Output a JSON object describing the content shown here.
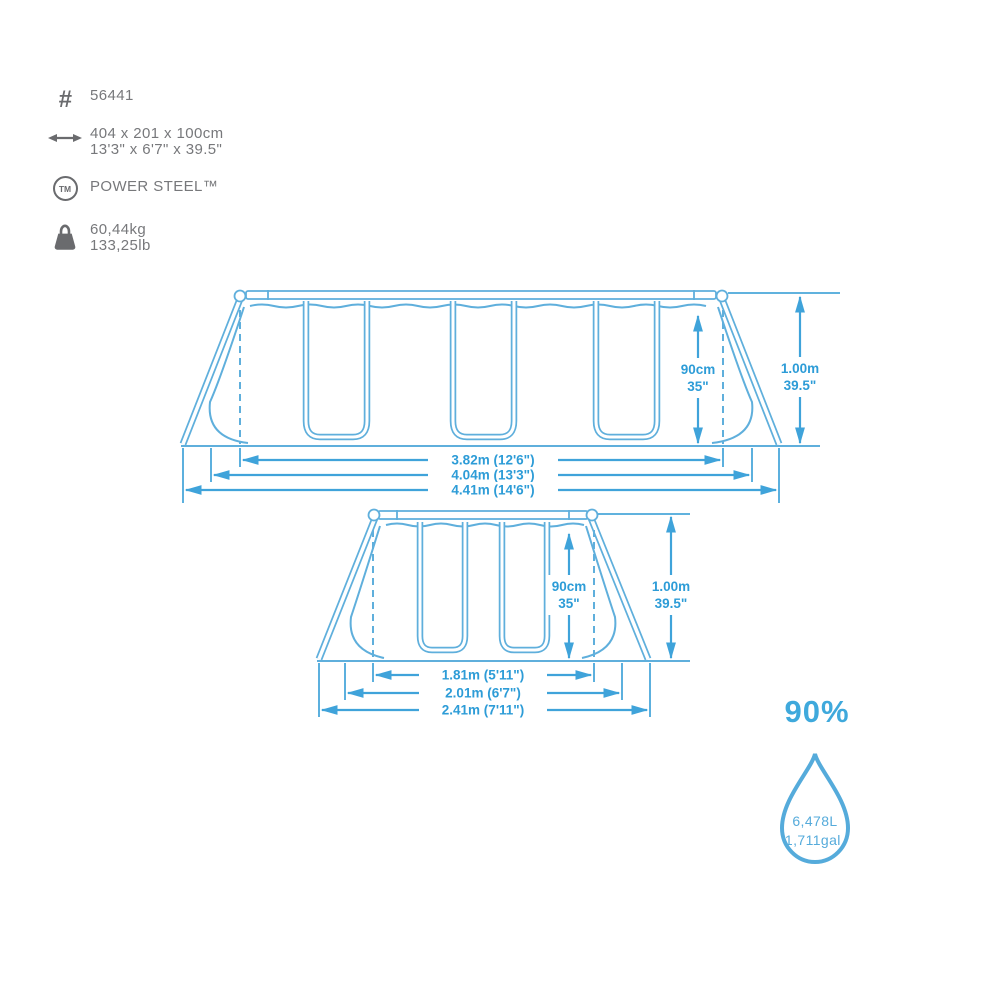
{
  "specs": {
    "item_number": "56441",
    "size_metric": "404 x 201 x 100cm",
    "size_imperial": "13'3\" x 6'7\" x 39.5\"",
    "frame_brand": "POWER STEEL™",
    "weight_kg": "60,44kg",
    "weight_lb": "133,25lb",
    "tm_icon_label": "TM",
    "hash_icon_glyph": "#"
  },
  "side_view": {
    "wall_height_metric": "90cm",
    "wall_height_imperial": "35\"",
    "frame_height_metric": "1.00m",
    "frame_height_imperial": "39.5\"",
    "length_water": "3.82m (12'6\")",
    "length_top": "4.04m (13'3\")",
    "length_footprint": "4.41m (14'6\")"
  },
  "end_view": {
    "wall_height_metric": "90cm",
    "wall_height_imperial": "35\"",
    "frame_height_metric": "1.00m",
    "frame_height_imperial": "39.5\"",
    "width_water": "1.81m (5'11\")",
    "width_top": "2.01m (6'7\")",
    "width_footprint": "2.41m (7'11\")"
  },
  "capacity": {
    "fill_level": "90%",
    "volume_liters": "6,478L",
    "volume_gallons": "1,711gal."
  },
  "colors": {
    "structure_blue": "#5fafdc",
    "dimension_blue": "#3fa3da",
    "dimension_text_blue": "#2d9cd7",
    "accent_blue": "#3fa9dc",
    "text_gray": "#77787b",
    "icon_gray": "#6a6b6e"
  }
}
